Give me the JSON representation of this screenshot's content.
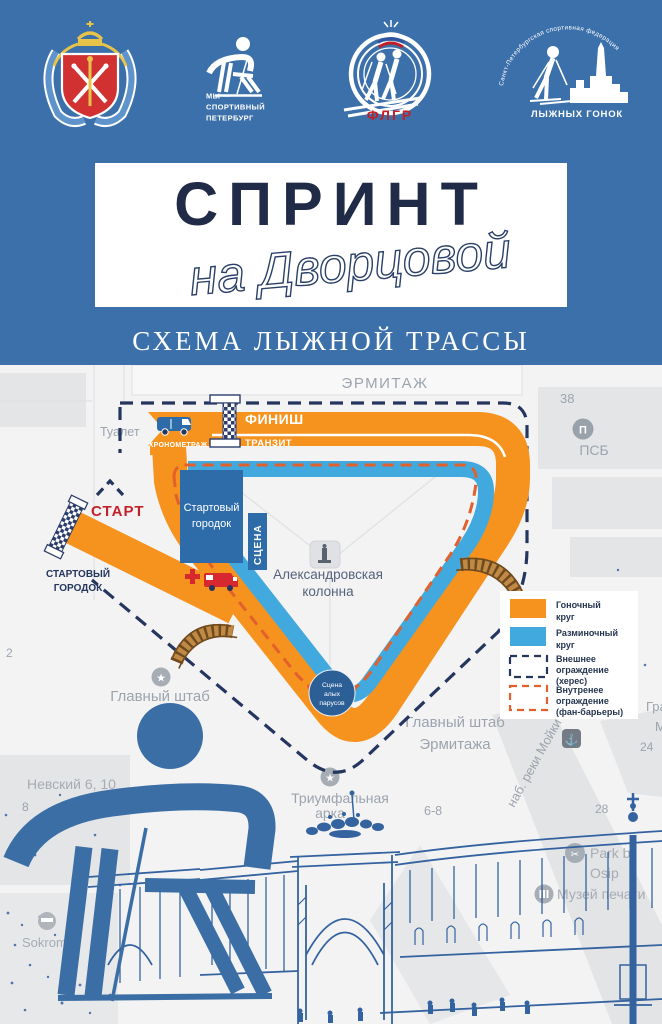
{
  "header": {
    "title_main": "СПРИНТ",
    "title_script": "на Дворцовой",
    "subtitle": "СХЕМА ЛЫЖНОЙ ТРАССЫ",
    "logos": {
      "sport_petersburg": [
        "МЫ —",
        "СПОРТИВНЫЙ",
        "ПЕТЕРБУРГ"
      ],
      "flgr": "ФЛГР",
      "federation_arc": "Санкт-Петербургская спортивная федерация",
      "federation_name": "ЛЫЖНЫХ ГОНОК"
    }
  },
  "map": {
    "labels": {
      "hermitage": "ЭРМИТАЖ",
      "num_38": "38",
      "psb": "ПСБ",
      "toilet": "Туалет",
      "num_2": "2",
      "start_area_line1": "СТАРТОВЫЙ",
      "start_area_line2": "ГОРОДОК",
      "glavny_shtab": "Главный штаб",
      "gse_line1": "Главный штаб",
      "gse_line2": "Эрмитажа",
      "triumf_line1": "Триумфальная",
      "triumf_line2": "арка",
      "num_6_8": "6-8",
      "moyka": "наб. реки Мойки",
      "num_28": "28",
      "num_24": "24",
      "gra": "Гра",
      "m": "М",
      "nevsky": "Невский 6, 10",
      "num_8": "8",
      "sokroma": "Sokroma",
      "park_line1": "Park b",
      "park_line2": "Osip",
      "musey": "Музей печати",
      "column_line1": "Александровская",
      "column_line2": "колонна"
    },
    "course": {
      "start": "СТАРТ",
      "finish": "ФИНИШ",
      "transit": "ТРАНЗИТ",
      "timing": "ХРОНОМЕТРАЖ",
      "start_town_line1": "Стартовый",
      "start_town_line2": "городок",
      "stage": "СЦЕНА",
      "sails_line1": "Сцена",
      "sails_line2": "алых",
      "sails_line3": "парусов"
    },
    "legend": {
      "race_line1": "Гоночный",
      "race_line2": "круг",
      "warmup_line1": "Разминочный",
      "warmup_line2": "круг",
      "outer_line1": "Внешнее",
      "outer_line2": "ограждение",
      "outer_line3": "(херес)",
      "inner_line1": "Внутренее",
      "inner_line2": "ограждение",
      "inner_line3": "(фан-барьеры)"
    },
    "colors": {
      "race": "#F6921E",
      "warmup": "#42A9DE",
      "outer_fence": "#24365E",
      "inner_fence": "#E2602C"
    },
    "icons": {
      "star": "★",
      "anchor": "⚓",
      "scissors": "✂",
      "psb": "П"
    }
  }
}
